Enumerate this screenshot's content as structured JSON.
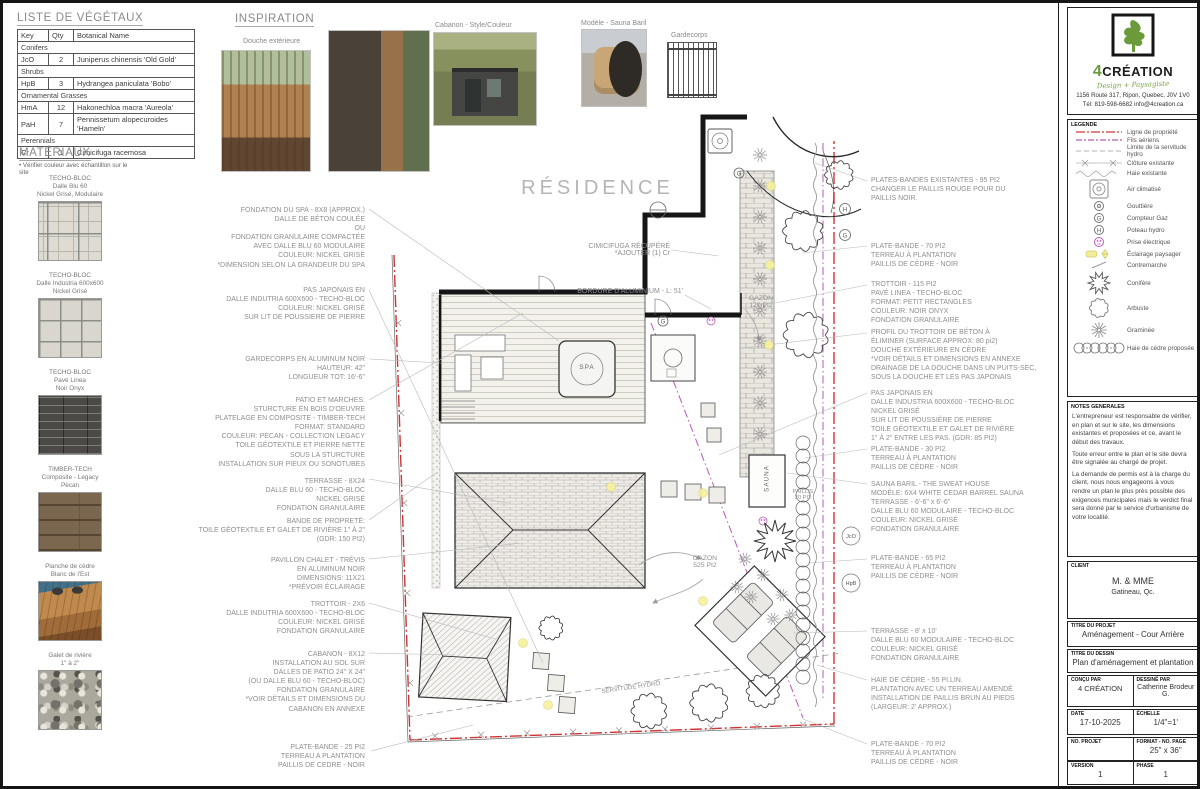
{
  "company": {
    "number": "4",
    "name": "CRÉATION",
    "tagline": "Design + Paysagiste",
    "address": "1156 Route 317, Ripon, Quebec, J0V 1V0",
    "contact": "Tél: 819-598-6682  info@4creation.ca"
  },
  "plant_table": {
    "title": "LISTE DE VÉGÉTAUX",
    "headers": [
      "Key",
      "Qty",
      "Botanical Name"
    ],
    "rows": [
      {
        "type": "group",
        "label": "Conifers"
      },
      {
        "type": "plant",
        "key": "JcO",
        "qty": "2",
        "name": "Juniperus chinensis 'Old Gold'"
      },
      {
        "type": "group",
        "label": "Shrubs"
      },
      {
        "type": "plant",
        "key": "HpB",
        "qty": "3",
        "name": "Hydrangea paniculata 'Bobo'"
      },
      {
        "type": "group",
        "label": "Ornamental Grasses"
      },
      {
        "type": "plant",
        "key": "HmA",
        "qty": "12",
        "name": "Hakonechloa macra 'Aureola'"
      },
      {
        "type": "plant",
        "key": "PaH",
        "qty": "7",
        "name": "Pennissetum alopecuroides 'Hameln'"
      },
      {
        "type": "group",
        "label": "Perennials"
      },
      {
        "type": "plant",
        "key": "Cr",
        "qty": "1",
        "name": "Cimicifuga racemosa"
      }
    ]
  },
  "materials": {
    "title": "MATÉRIAUX",
    "note": "• Vérifier couleur avec échantillon sur le site",
    "items": [
      {
        "swatch": "modular",
        "label": "TECHO-BLOC\nDalle Blu 60\nNickel Grisé, Modulaire"
      },
      {
        "swatch": "grid600",
        "label": "TECHO-BLOC\nDalle Industria 600x600\nNickel Grisé"
      },
      {
        "swatch": "linea",
        "label": "TECHO-BLOC\nPavé Linea\nNoir Onyx"
      },
      {
        "swatch": "timber",
        "label": "TIMBER-TECH\nComposite - Legacy\nPecan"
      },
      {
        "swatch": "cedar",
        "label": "Planche de cèdre\nBlanc de l'Est"
      },
      {
        "swatch": "rock",
        "label": "Galet de rivière\n1\" à 2\""
      }
    ]
  },
  "inspiration": {
    "title": "INSPIRATION",
    "labels": {
      "shower": "Douche extérieure",
      "shed": "Cabanon - Style/Couleur",
      "sauna": "Modèle - Sauna Baril",
      "railing": "Gardecorps"
    }
  },
  "plan": {
    "residence_label": "RÉSIDENCE",
    "spa_label": "SPA",
    "sauna_label": "SAUNA",
    "gazon_small": "GAZON\n120 PI2",
    "gazon_large": "GAZON\n525 PI2",
    "paillis_label": "PAILLIS\n20 PI2",
    "servitude_label": "SERVITUDE HYDRO",
    "cimicifuga_label": "CIMICIFUGA RÉCUPÉRÉ\n*AJOUTER (1) Cr",
    "bordure_label": "BORDURE D'ALUMINIUM - L: 51'",
    "callouts": [
      "JcO",
      "HpB"
    ],
    "left_annotations": [
      [
        "FONDATION DU SPA - 8X8 (APPROX.)",
        "DALLE DE BÉTON COULÉE",
        "OU",
        "FONDATION GRANULAIRE COMPACTÉE",
        "AVEC DALLE BLU 60 MODULAIRE",
        "COULEUR: NICKEL GRISÉ",
        "*DIMENSION SELON LA GRANDEUR DU SPA"
      ],
      [
        "PAS JAPONAIS EN",
        "DALLE INDUTRIA 600X600 - TECHO-BLOC",
        "COULEUR: NICKEL GRISÉ",
        "SUR LIT DE POUSSIERE DE PIERRE"
      ],
      [
        "GARDECORPS EN ALUMINUM NOIR",
        "HAUTEUR: 42\"",
        "LONGUEUR TOT: 16'-6\""
      ],
      [
        "PATIO ET MARCHES:",
        "STURCTURE EN BOIS D'OEUVRE",
        "PLATELAGE EN COMPOSITE - TIMBER-TECH",
        "FORMAT: STANDARD",
        "COULEUR: PECAN - COLLECTION LEGACY",
        "TOILE GÉOTEXTILE ET PIERRE NETTE",
        "SOUS LA STURCTURE",
        "INSTALLATION SUR PIEUX OU SONOTUBES"
      ],
      [
        "TERRASSE - 8X24",
        "DALLE BLU 60 - TECHO-BLOC",
        "NICKEL GRISÉ",
        "FONDATION GRANULAIRE"
      ],
      [
        "BANDE DE PROPRETÉ:",
        "TOILE GÉOTEXTILE ET GALET DE RIVIÈRE 1\" À 2\"",
        "(GDR: 150 PI2)"
      ],
      [
        "PAVILLON CHALET - TRÉVIS",
        "EN ALUMINUM NOIR",
        "DIMENSIONS: 11X21",
        "*PRÉVOIR ÉCLAIRAGE"
      ],
      [
        "TROTTOIR - 2X6",
        "DALLE INDUTRIA 600X600 - TECHO-BLOC",
        "COULEUR: NICKEL GRISÉ",
        "FONDATION GRANULAIRE"
      ],
      [
        "CABANON - 8X12",
        "INSTALLATION AU SOL SUR",
        "DALLES DE PATIO 24\" X 24\"",
        "(OU DALLE BLU 60 - TECHO-BLOC)",
        "FONDATION GRANULAIRE",
        "*VOIR DÉTAILS ET DIMENSIONS DU",
        "CABANON EN ANNEXE"
      ],
      [
        "PLATE-BANDE - 25 PI2",
        "TERREAU A PLANTATION",
        "PAILLIS DE CEDRE - NOIR"
      ]
    ],
    "right_annotations": [
      [
        "PLATES-BANDES EXISTANTES - 95 PI2",
        "CHANGER LE PAILLIS ROUGE POUR DU",
        "PAILLIS NOIR."
      ],
      [
        "PLATE-BANDE - 70 PI2",
        "TERREAU À PLANTATION",
        "PAILLIS DE CÈDRE - NOIR"
      ],
      [
        "TROTTOIR - 115 PI2",
        "PAVÉ LINEA - TECHO-BLOC",
        "FORMAT: PETIT RECTANGLES",
        "COULEUR: NOIR ONYX",
        "FONDATION GRANULAIRE"
      ],
      [
        "PROFIL DU TROTTOIR DE BÉTON À",
        "ÉLIMINER (SURFACE APPROX: 80 pi2)",
        "DOUCHE EXTÉRIEURE EN CÈDRE",
        "*VOIR DÉTAILS ET DIMENSIONS EN ANNEXE",
        "DRAINAGE DE LA DOUCHE DANS UN PUITS-SEC,",
        "SOUS LA DOUCHE ET LES PAS JAPONAIS"
      ],
      [
        "PAS JAPONAIS EN",
        "DALLE INDUSTRIA 600X600 - TECHO-BLOC",
        "NICKEL GRISÉ",
        "SUR LIT DE POUSSIÈRE DE PIERRE",
        "TOILE GÉOTEXTILE ET GALET DE RIVIÈRE",
        "1\" À 2\" ENTRE LES PAS. (GDR: 85 PI2)"
      ],
      [
        "PLATE-BANDE - 30 PI2",
        "TERREAU À PLANTATION",
        "PAILLIS DE CÈDRE - NOIR"
      ],
      [
        "SAUNA BARIL - THE SWEAT HOUSE",
        "MODÈLE: 6X4 WHITE CEDAR BARREL SAUNA",
        "TERRASSE - 6'-6\" x 6'-6\"",
        "DALLE BLU 60 MODULAIRE - TECHO-BLOC",
        "COULEUR: NICKEL GRISÉ",
        "FONDATION GRANULAIRE"
      ],
      [
        "PLATE-BANDE - 65 PI2",
        "TERREAU À PLANTATION",
        "PAILLIS DE CÈDRE - NOIR"
      ],
      [
        "TERRASSE - 8' x 10'",
        "DALLE BLU 60 MODULAIRE - TECHO-BLOC",
        "COULEUR: NICKEL GRISÉ",
        "FONDATION GRANULAIRE"
      ],
      [
        "HAIE DE CÈDRE - 55 PI.LIN.",
        "PLANTATION AVEC UN TERREAU AMENDÉ",
        "INSTALLATION DE PAILLIS BRUN AU PIEDS",
        "(LARGEUR: 2' APPROX.)"
      ],
      [
        "PLATE-BANDE - 70 PI2",
        "TERREAU À PLANTATION",
        "PAILLIS DE CÈDRE - NOIR"
      ]
    ]
  },
  "legend": {
    "title": "LEGENDE",
    "items": [
      {
        "icon": "property-line",
        "label": "Ligne de propriété"
      },
      {
        "icon": "overhead-wires",
        "label": "Fils aériens"
      },
      {
        "icon": "hydro-easement",
        "label": "Limite de la servitude hydro"
      },
      {
        "icon": "existing-fence",
        "label": "Clôture existante"
      },
      {
        "icon": "existing-hedge",
        "label": "Haie existante"
      },
      {
        "icon": "ac-unit",
        "label": "Air climatisé"
      },
      {
        "icon": "gutter",
        "label": "Gouttière"
      },
      {
        "icon": "gas-meter",
        "label": "Compteur Gaz"
      },
      {
        "icon": "hydro-pole",
        "label": "Poteau hydro"
      },
      {
        "icon": "electrical-outlet",
        "label": "Prise électrique"
      },
      {
        "icon": "landscape-light",
        "label": "Éclairage paysager"
      },
      {
        "icon": "stair-riser",
        "label": "Contremarche"
      },
      {
        "icon": "conifer",
        "label": "Conifère"
      },
      {
        "icon": "shrub",
        "label": "Arbuste"
      },
      {
        "icon": "ornamental-grass",
        "label": "Graminée"
      },
      {
        "icon": "proposed-cedar-hedge",
        "label": "Haie de cèdre proposée"
      }
    ]
  },
  "notes": {
    "title": "NOTES GENERALES",
    "paragraphs": [
      "L'entrepreneur est responsable de vérifier, en plan et sur le site, les dimensions existantes et proposées et ce, avant le début des travaux.",
      "Toute erreur entre le plan et le site devra être signalée au chargé de projet.",
      "La demande de permis est à la charge du client, nous nous engageons à vous rendre un plan le plus près possible des exigences municipales mais le verdict final sera donné par le service d'urbanisme de votre localité."
    ]
  },
  "titleblock": {
    "client": {
      "label": "CLIENT",
      "name": "M. & MME",
      "city": "Gatineau, Qc."
    },
    "project": {
      "label": "TITRE DU PROJET",
      "value": "Aménagement - Cour Arrière"
    },
    "drawing": {
      "label": "TITRE DU DESSIN",
      "value": "Plan d'aménagement et plantation"
    },
    "designed_by": {
      "label": "CONÇU PAR",
      "value": "4 CRÉATION"
    },
    "drawn_by": {
      "label": "DESSINÉ PAR",
      "value": "Catherine Brodeur G."
    },
    "date": {
      "label": "DATE",
      "value": "17-10-2025"
    },
    "scale": {
      "label": "ÉCHELLE",
      "value": "1/4\"=1'"
    },
    "project_no": {
      "label": "NO. PROJET",
      "value": ""
    },
    "format": {
      "label": "FORMAT - NO. PAGE",
      "value": "25\" x 36\""
    },
    "version": {
      "label": "VERSION",
      "value": "1"
    },
    "phase": {
      "label": "PHASE",
      "value": "1"
    }
  }
}
